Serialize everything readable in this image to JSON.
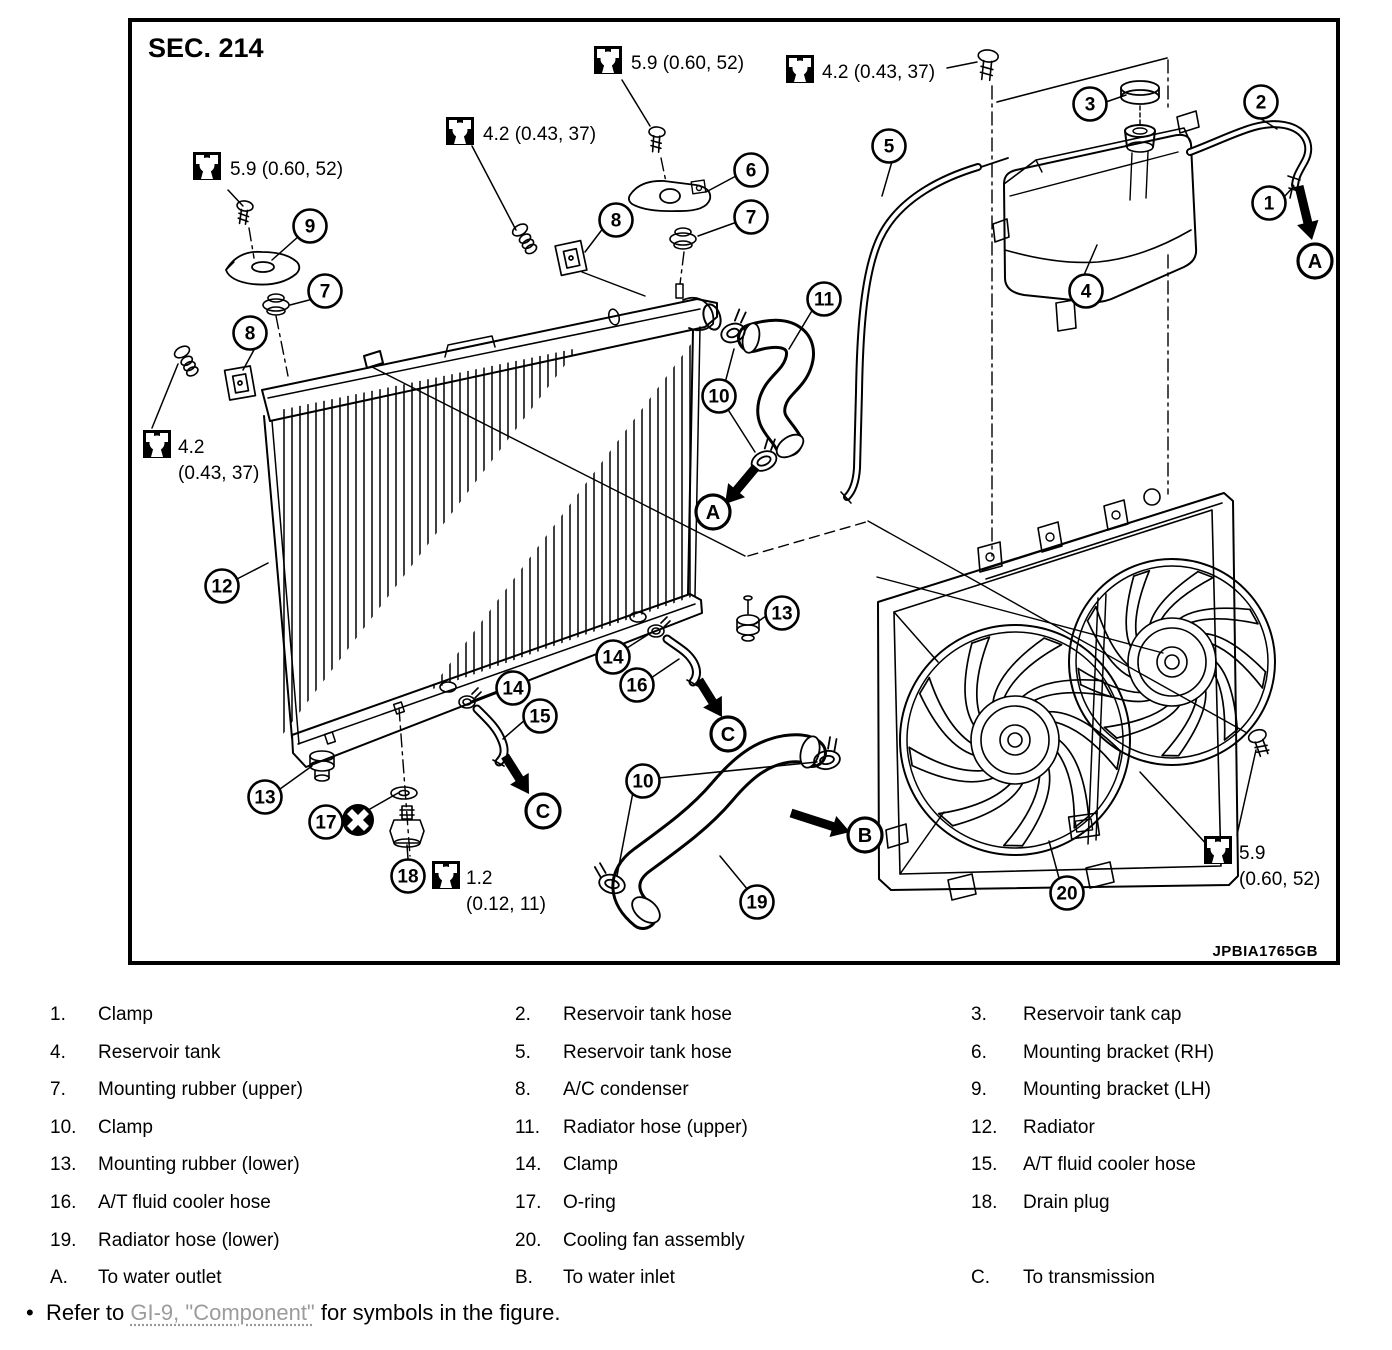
{
  "colors": {
    "ink": "#000000",
    "paper": "#ffffff",
    "link_gray": "#9b9b9b"
  },
  "figure": {
    "section_label": "SEC. 214",
    "figure_code": "JPBIA1765GB",
    "torque_labels": [
      {
        "lines": [
          "5.9 (0.60, 52)"
        ],
        "box_x": 193,
        "box_y": 152,
        "text_x": 230,
        "text_y": 175
      },
      {
        "lines": [
          "5.9 (0.60, 52)"
        ],
        "box_x": 594,
        "box_y": 46,
        "text_x": 631,
        "text_y": 69
      },
      {
        "lines": [
          "4.2 (0.43, 37)"
        ],
        "box_x": 446,
        "box_y": 117,
        "text_x": 483,
        "text_y": 140
      },
      {
        "lines": [
          "4.2 (0.43, 37)"
        ],
        "box_x": 786,
        "box_y": 55,
        "text_x": 822,
        "text_y": 78
      },
      {
        "lines": [
          "4.2",
          "(0.43, 37)"
        ],
        "box_x": 143,
        "box_y": 430,
        "text_x": 178,
        "text_y": 453
      },
      {
        "lines": [
          "1.2",
          "(0.12, 11)"
        ],
        "box_x": 432,
        "box_y": 861,
        "text_x": 466,
        "text_y": 884
      },
      {
        "lines": [
          "5.9",
          "(0.60, 52)"
        ],
        "box_x": 1204,
        "box_y": 836,
        "text_x": 1239,
        "text_y": 859
      }
    ],
    "callouts": [
      {
        "label": "9",
        "x": 310,
        "y": 226
      },
      {
        "label": "7",
        "x": 325,
        "y": 291
      },
      {
        "label": "8",
        "x": 250,
        "y": 333
      },
      {
        "label": "12",
        "x": 222,
        "y": 586
      },
      {
        "label": "13",
        "x": 265,
        "y": 797
      },
      {
        "label": "17",
        "x": 326,
        "y": 822
      },
      {
        "label": "18",
        "x": 408,
        "y": 876
      },
      {
        "label": "6",
        "x": 751,
        "y": 170
      },
      {
        "label": "7",
        "x": 751,
        "y": 217
      },
      {
        "label": "8",
        "x": 616,
        "y": 220
      },
      {
        "label": "5",
        "x": 889,
        "y": 146
      },
      {
        "label": "3",
        "x": 1090,
        "y": 104
      },
      {
        "label": "2",
        "x": 1261,
        "y": 102
      },
      {
        "label": "1",
        "x": 1269,
        "y": 203
      },
      {
        "label": "4",
        "x": 1086,
        "y": 291
      },
      {
        "label": "11",
        "x": 824,
        "y": 299
      },
      {
        "label": "10",
        "x": 719,
        "y": 396
      },
      {
        "label": "13",
        "x": 782,
        "y": 613
      },
      {
        "label": "14",
        "x": 613,
        "y": 657
      },
      {
        "label": "16",
        "x": 637,
        "y": 685
      },
      {
        "label": "14",
        "x": 513,
        "y": 688
      },
      {
        "label": "15",
        "x": 540,
        "y": 716
      },
      {
        "label": "10",
        "x": 643,
        "y": 781
      },
      {
        "label": "19",
        "x": 757,
        "y": 902
      },
      {
        "label": "20",
        "x": 1067,
        "y": 893
      }
    ],
    "flow_letters": [
      {
        "label": "A",
        "x": 1315,
        "y": 261
      },
      {
        "label": "A",
        "x": 713,
        "y": 512
      },
      {
        "label": "B",
        "x": 865,
        "y": 835
      },
      {
        "label": "C",
        "x": 728,
        "y": 734
      },
      {
        "label": "C",
        "x": 543,
        "y": 811
      }
    ]
  },
  "legend": {
    "rows": [
      [
        {
          "num": "1.",
          "label": "Clamp"
        },
        {
          "num": "2.",
          "label": "Reservoir tank hose"
        },
        {
          "num": "3.",
          "label": "Reservoir tank cap"
        }
      ],
      [
        {
          "num": "4.",
          "label": "Reservoir tank"
        },
        {
          "num": "5.",
          "label": "Reservoir tank hose"
        },
        {
          "num": "6.",
          "label": "Mounting bracket (RH)"
        }
      ],
      [
        {
          "num": "7.",
          "label": "Mounting rubber (upper)"
        },
        {
          "num": "8.",
          "label": "A/C condenser"
        },
        {
          "num": "9.",
          "label": "Mounting bracket (LH)"
        }
      ],
      [
        {
          "num": "10.",
          "label": "Clamp"
        },
        {
          "num": "11.",
          "label": "Radiator hose (upper)"
        },
        {
          "num": "12.",
          "label": "Radiator"
        }
      ],
      [
        {
          "num": "13.",
          "label": "Mounting rubber (lower)"
        },
        {
          "num": "14.",
          "label": "Clamp"
        },
        {
          "num": "15.",
          "label": "A/T fluid cooler hose"
        }
      ],
      [
        {
          "num": "16.",
          "label": "A/T fluid cooler hose"
        },
        {
          "num": "17.",
          "label": "O-ring"
        },
        {
          "num": "18.",
          "label": "Drain plug"
        }
      ],
      [
        {
          "num": "19.",
          "label": "Radiator hose (lower)"
        },
        {
          "num": "20.",
          "label": "Cooling fan assembly"
        },
        null
      ],
      [
        {
          "num": "A.",
          "label": "To water outlet"
        },
        {
          "num": "B.",
          "label": "To water inlet"
        },
        {
          "num": "C.",
          "label": "To transmission"
        }
      ]
    ]
  },
  "note": {
    "bullet": "•",
    "prefix": "Refer to ",
    "link": "GI-9, \"Component\"",
    "suffix": " for symbols in the figure."
  }
}
